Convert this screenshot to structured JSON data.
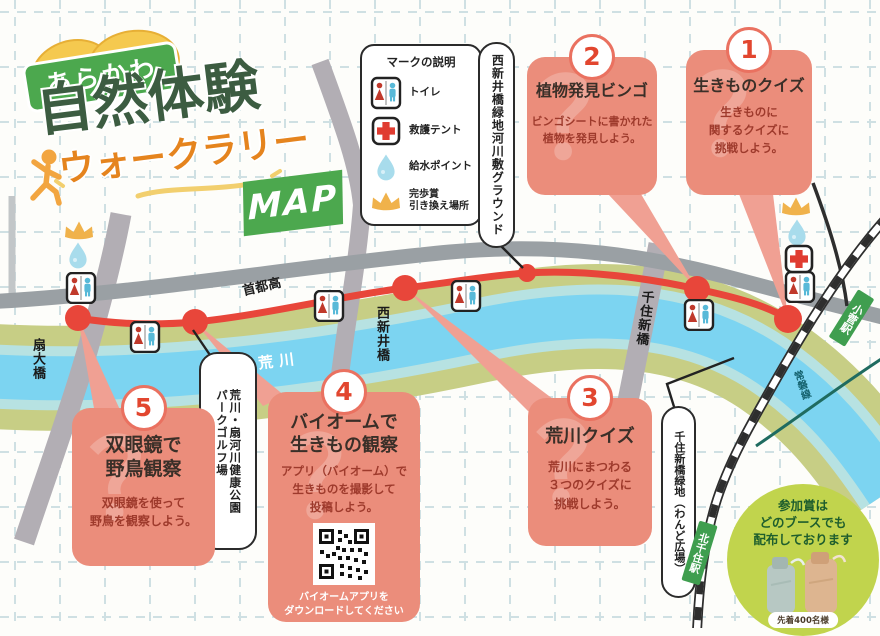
{
  "title": {
    "badge": "あらかわ",
    "main": "自然体験",
    "sub": "ウォークラリー",
    "map_badge": "MAP"
  },
  "legend": {
    "title": "マークの説明",
    "items": [
      {
        "icon": "toilet-icon",
        "label": "トイレ"
      },
      {
        "icon": "first-aid-tent-icon",
        "label": "救護テント"
      },
      {
        "icon": "water-point-icon",
        "label": "給水ポイント"
      },
      {
        "icon": "prize-crown-icon",
        "label": "完歩賞\n引き換え場所"
      }
    ]
  },
  "stations": [
    {
      "number": "1",
      "title": "生きものクイズ",
      "description": "生きものに\n関するクイズに\n挑戦しよう。"
    },
    {
      "number": "2",
      "title": "植物発見ビンゴ",
      "description": "ビンゴシートに書かれた\n植物を発見しよう。"
    },
    {
      "number": "3",
      "title": "荒川クイズ",
      "description": "荒川にまつわる\n３つのクイズに\n挑戦しよう。"
    },
    {
      "number": "4",
      "title": "バイオームで\n生きもの観察",
      "description": "アプリ（バイオーム）で\n生きものを撮影して\n投稿しよう。",
      "qr_caption": "バイオームアプリを\nダウンロードしてください"
    },
    {
      "number": "5",
      "title": "双眼鏡で\n野鳥観察",
      "description": "双眼鏡を使って\n野鳥を観察しよう。"
    }
  ],
  "map_labels": {
    "ground": "西新井橋緑地河川敷グラウンド",
    "park": "荒川・扇河川健康公園\nパークゴルフ場",
    "wando": "千住新橋緑地（わんど広場）",
    "river": "荒川",
    "expressway": "首都高",
    "bridge_ogi": "扇大橋",
    "bridge_nishiarai": "西新井橋",
    "bridge_senju": "千住新橋",
    "station_kitasenju": "北千住駅",
    "station_kosuge": "小菅駅",
    "rail_line": "常磐線"
  },
  "prize": {
    "text": "参加賞は\nどのブースでも\n配布しております",
    "note": "先着400名様"
  },
  "decor": {
    "watermark": "？"
  },
  "colors": {
    "route_red": "#e8463a",
    "callout_salmon": "#eb8d7b",
    "brand_green": "#4ca84e",
    "river_blue": "#7cd4f1",
    "bank_green": "#c7ce85",
    "expressway_gray": "#9aa0a4",
    "prize_circle_green": "#c1d44d",
    "title_dark_green": "#3c5c41",
    "title_orange": "#e5841e"
  }
}
